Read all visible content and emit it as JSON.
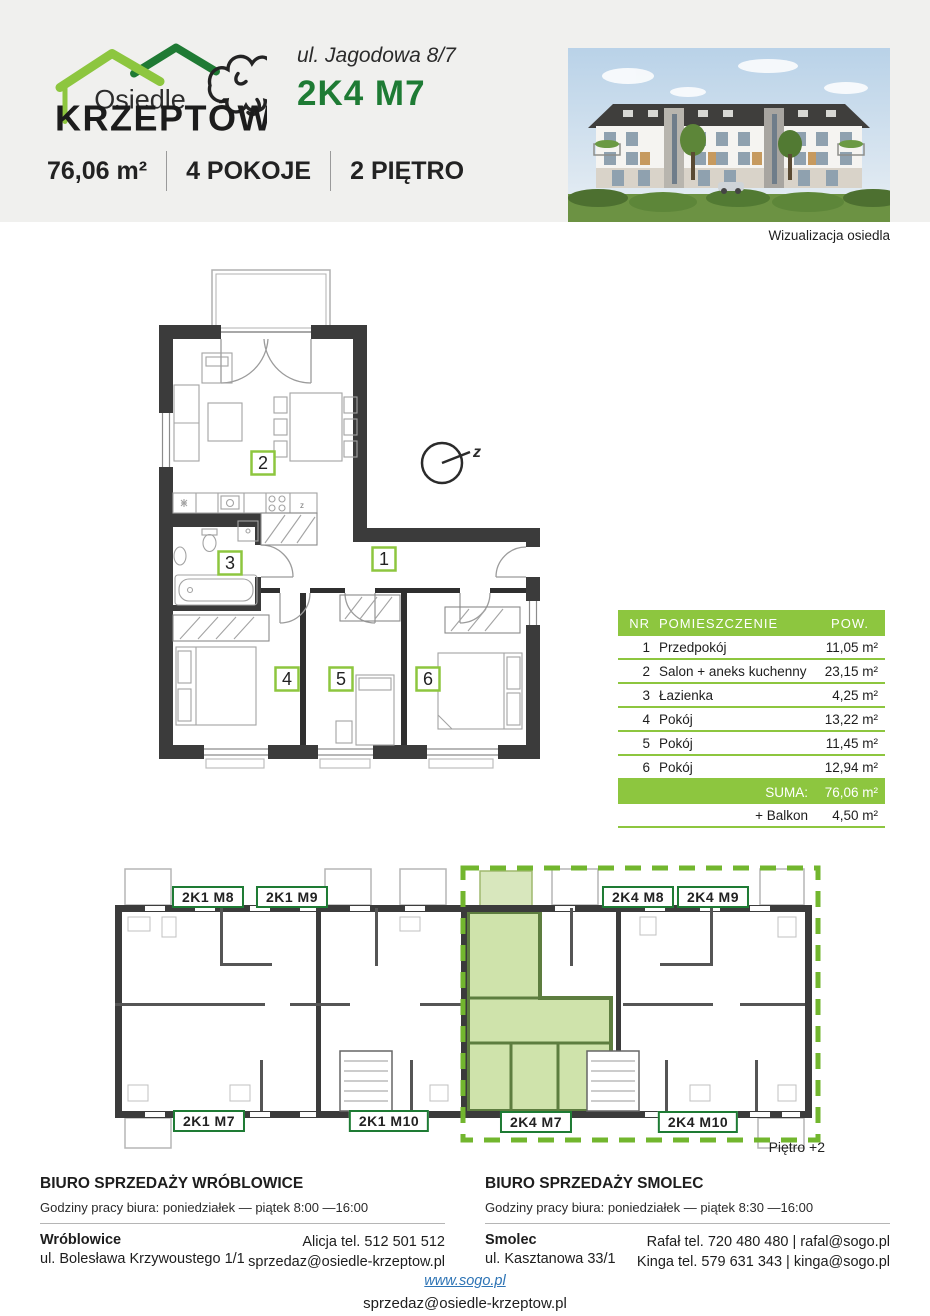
{
  "header": {
    "logo_line1": "Osiedle",
    "logo_line2": "KRZEPTÓW",
    "address": "ul. Jagodowa 8/7",
    "unit_code": "2K4 M7",
    "stats": [
      {
        "label": "76,06 m²"
      },
      {
        "label": "4 POKOJE"
      },
      {
        "label": "2 PIĘTRO"
      }
    ],
    "photo_caption": "Wizualizacja osiedla"
  },
  "floor_plan": {
    "room_numbers": [
      "1",
      "2",
      "3",
      "4",
      "5",
      "6"
    ],
    "compass_label": "z",
    "kitchen_mark": "z"
  },
  "room_table": {
    "col_nr": "NR",
    "col_name": "POMIESZCZENIE",
    "col_area": "POW.",
    "rows": [
      {
        "nr": "1",
        "name": "Przedpokój",
        "area": "11,05 m²"
      },
      {
        "nr": "2",
        "name": "Salon + aneks kuchenny",
        "area": "23,15 m²"
      },
      {
        "nr": "3",
        "name": "Łazienka",
        "area": "4,25 m²"
      },
      {
        "nr": "4",
        "name": "Pokój",
        "area": "13,22 m²"
      },
      {
        "nr": "5",
        "name": "Pokój",
        "area": "11,45 m²"
      },
      {
        "nr": "6",
        "name": "Pokój",
        "area": "12,94 m²"
      }
    ],
    "suma_label": "SUMA:",
    "suma_value": "76,06 m²",
    "balkon_label": "+ Balkon",
    "balkon_value": "4,50 m²"
  },
  "overview": {
    "units": [
      {
        "label": "2K1 M8"
      },
      {
        "label": "2K1 M9"
      },
      {
        "label": "2K4 M8"
      },
      {
        "label": "2K4 M9"
      },
      {
        "label": "2K1 M7"
      },
      {
        "label": "2K1 M10"
      },
      {
        "label": "2K4 M7"
      },
      {
        "label": "2K4 M10"
      }
    ],
    "floor_note": "Piętro +2"
  },
  "offices": [
    {
      "title": "BIURO SPRZEDAŻY WRÓBLOWICE",
      "hours": "Godziny pracy biura: poniedziałek — piątek 8:00 —16:00",
      "city": "Wróblowice",
      "street": "ul. Bolesława Krzywoustego 1/1",
      "contact_line1": "Alicja tel. 512 501 512",
      "contact_line2": "sprzedaz@osiedle-krzeptow.pl"
    },
    {
      "title": "BIURO SPRZEDAŻY SMOLEC",
      "hours": "Godziny pracy biura: poniedziałek — piątek 8:30 —16:00",
      "city": "Smolec",
      "street": "ul. Kasztanowa 33/1",
      "contact_line1": "Rafał tel. 720 480 480 | rafal@sogo.pl",
      "contact_line2": "Kinga tel. 579 631 343 | kinga@sogo.pl"
    }
  ],
  "footer": {
    "website": "www.sogo.pl",
    "email": "sprzedaz@osiedle-krzeptow.pl"
  },
  "colors": {
    "accent_green": "#8dc63f",
    "dark_green": "#1e7b34",
    "wall_dark": "#3b3b3b",
    "link_blue": "#2e74b5",
    "highlight_fill": "#cfe3ab"
  }
}
